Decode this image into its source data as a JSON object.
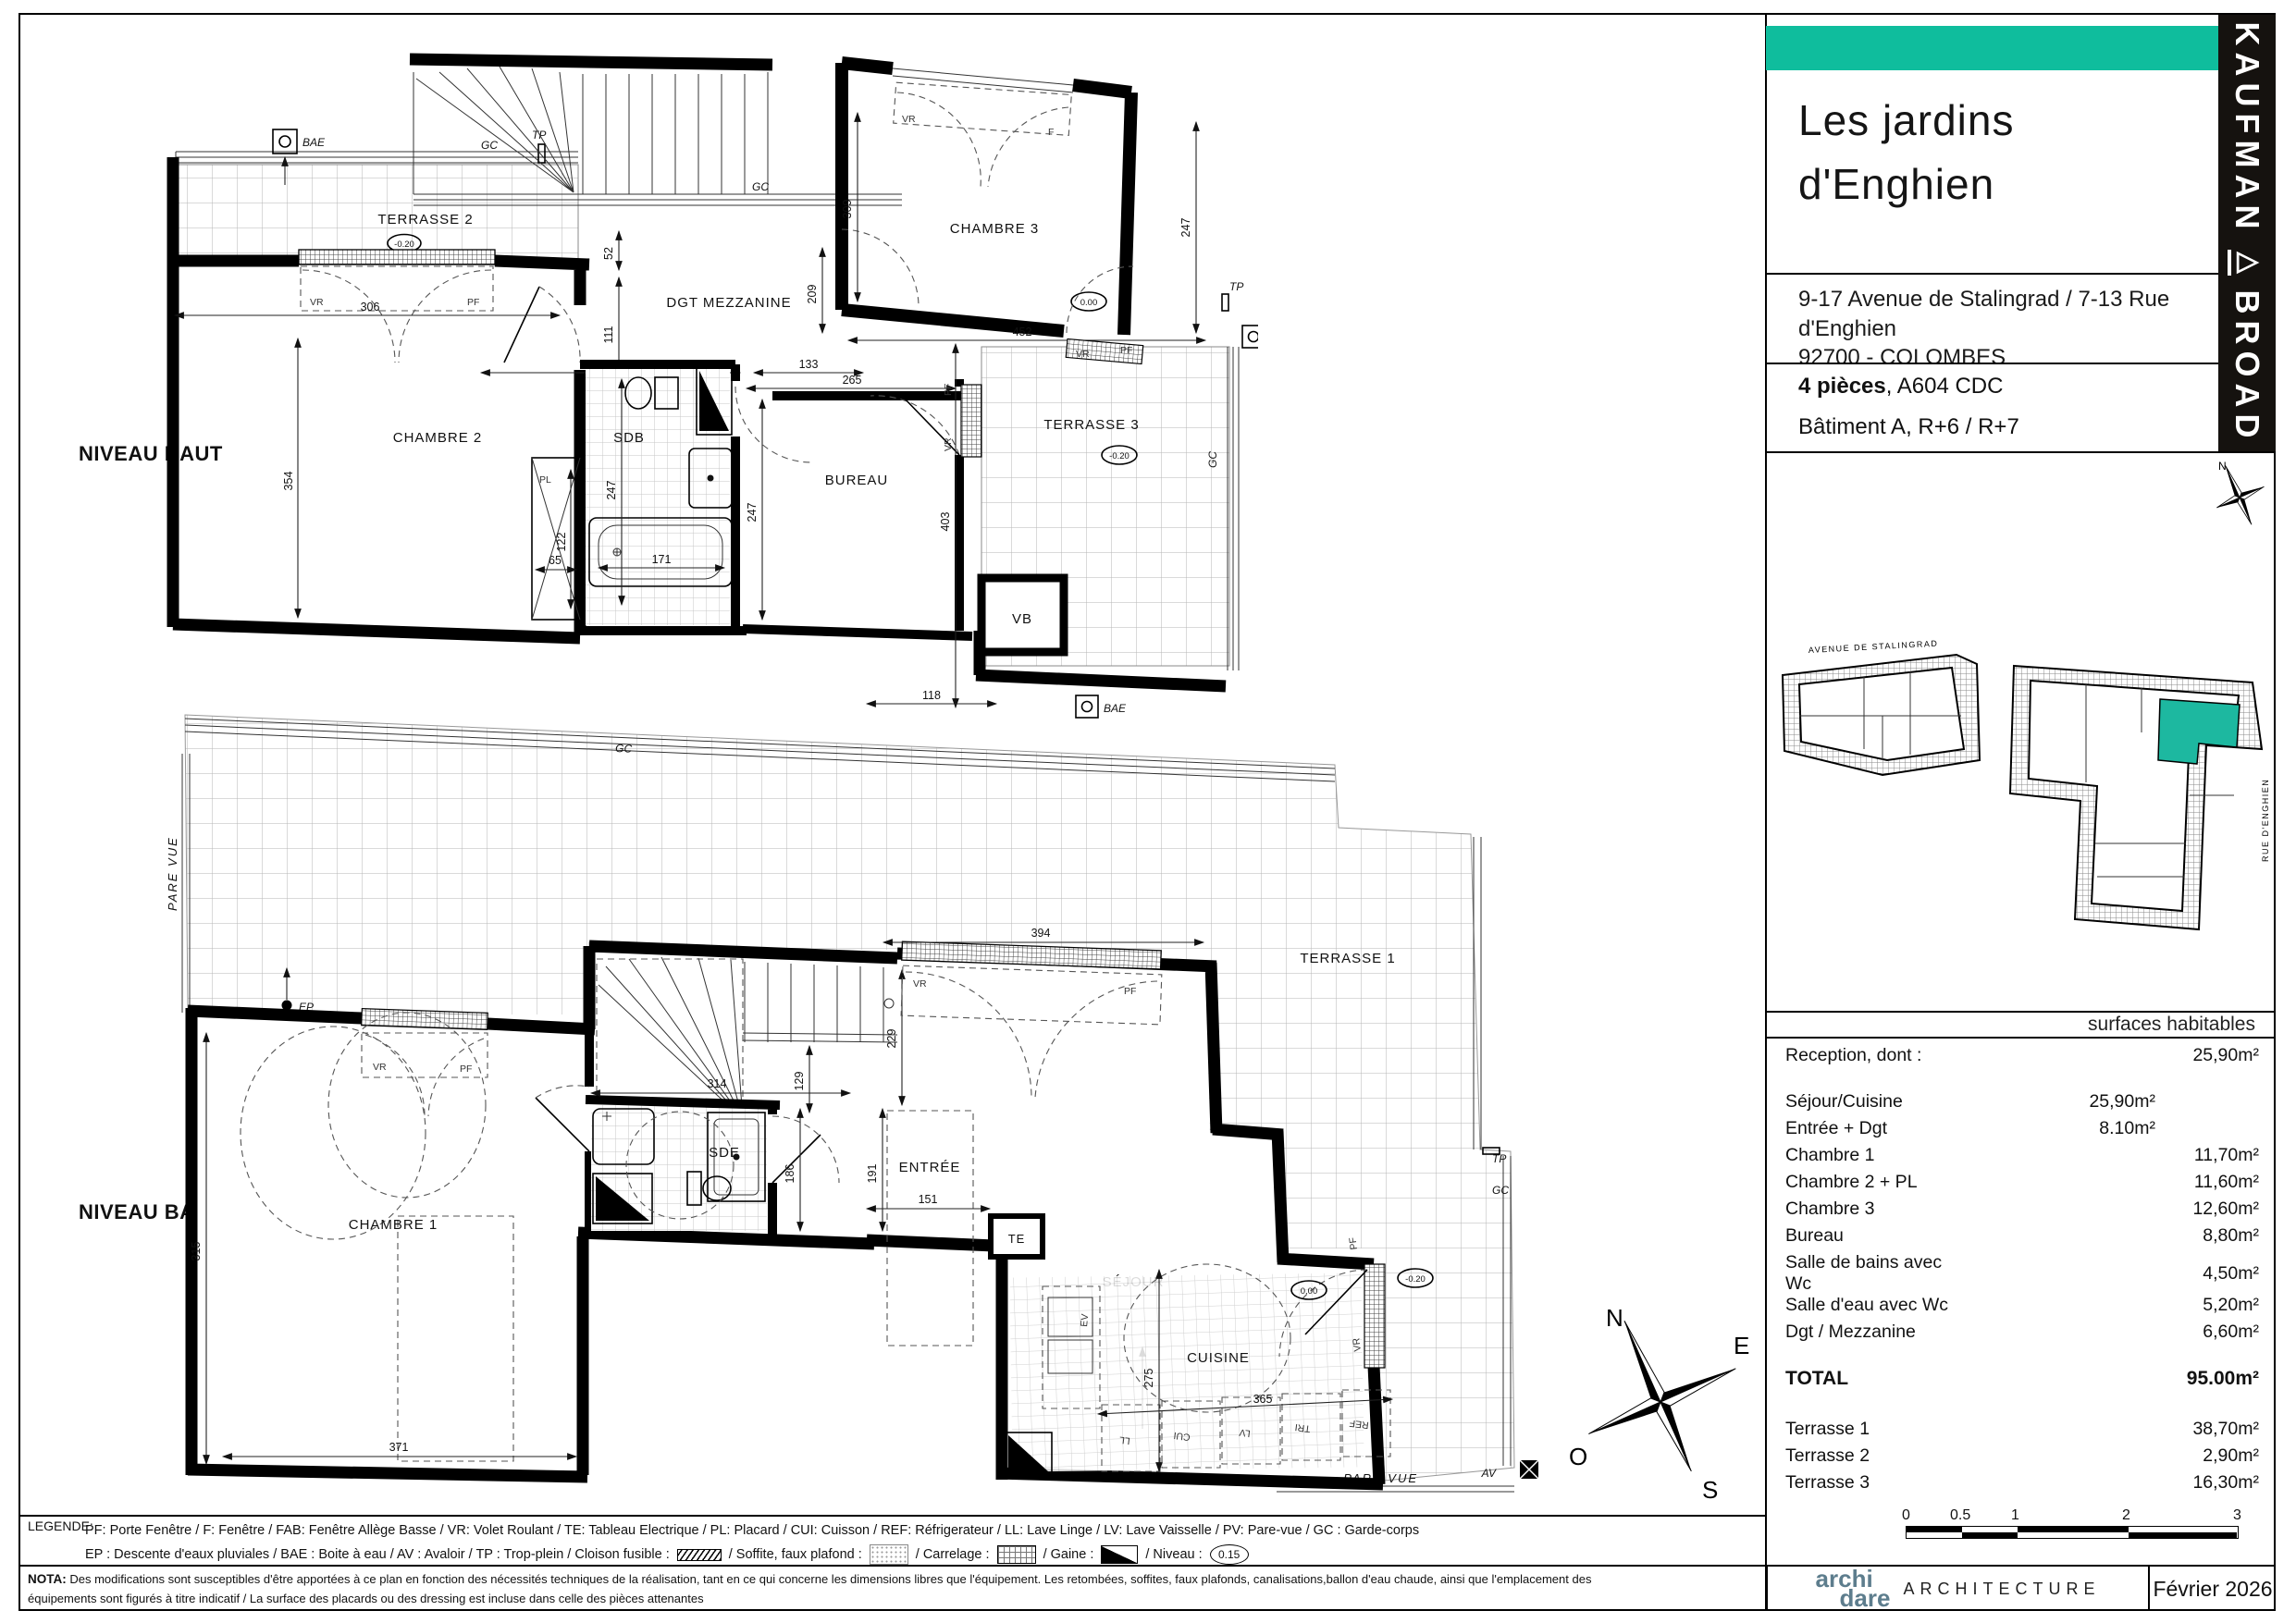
{
  "header": {
    "title_line1": "Les jardins",
    "title_line2": "d'Enghien",
    "address_line1": "9-17 Avenue de Stalingrad / 7-13 Rue",
    "address_line2": "d'Enghien",
    "address_line3": "92700 -  COLOMBES",
    "unit_rooms": "4 pièces",
    "unit_ref": ", A604 CDC",
    "building": "Bâtiment A, R+6 / R+7",
    "brand_word1": "KAUFMAN",
    "brand_logo": "△",
    "brand_word2": "BROAD",
    "accent_color": "#0fbd9d"
  },
  "site_plan": {
    "street_top": "AVENUE DE STALINGRAD",
    "street_right": "RUE D'ENGHIEN",
    "unit_color": "#1db8a0"
  },
  "surfaces": {
    "header": "surfaces habitables",
    "rows": [
      {
        "label": "Reception, dont :",
        "mid": "",
        "val": "25,90m²",
        "cls": ""
      },
      {
        "label": "",
        "mid": "",
        "val": "",
        "cls": "sp"
      },
      {
        "label": "Séjour/Cuisine",
        "mid": "25,90m²",
        "val": "",
        "cls": ""
      },
      {
        "label": "Entrée + Dgt",
        "mid": "8.10m²",
        "val": "",
        "cls": ""
      },
      {
        "label": "Chambre 1",
        "mid": "",
        "val": "11,70m²",
        "cls": ""
      },
      {
        "label": "Chambre 2 + PL",
        "mid": "",
        "val": "11,60m²",
        "cls": ""
      },
      {
        "label": "Chambre 3",
        "mid": "",
        "val": "12,60m²",
        "cls": ""
      },
      {
        "label": "Bureau",
        "mid": "",
        "val": "8,80m²",
        "cls": ""
      },
      {
        "label": "Salle de bains avec Wc",
        "mid": "",
        "val": "4,50m²",
        "cls": "wrap"
      },
      {
        "label": "Salle d'eau avec Wc",
        "mid": "",
        "val": "5,20m²",
        "cls": ""
      },
      {
        "label": "Dgt / Mezzanine",
        "mid": "",
        "val": "6,60m²",
        "cls": ""
      },
      {
        "label": "",
        "mid": "",
        "val": "",
        "cls": "sp"
      },
      {
        "label": "TOTAL",
        "mid": "",
        "val": "95.00m²",
        "cls": "total"
      },
      {
        "label": "",
        "mid": "",
        "val": "",
        "cls": "sp"
      },
      {
        "label": "Terrasse 1",
        "mid": "",
        "val": "38,70m²",
        "cls": ""
      },
      {
        "label": "Terrasse 2",
        "mid": "",
        "val": "2,90m²",
        "cls": ""
      },
      {
        "label": "Terrasse 3",
        "mid": "",
        "val": "16,30m²",
        "cls": ""
      }
    ]
  },
  "plans": {
    "upper_label": "NIVEAU HAUT",
    "lower_label": "NIVEAU BAS",
    "upper_rooms": {
      "terrasse2": "TERRASSE 2",
      "chambre2": "CHAMBRE 2",
      "dgt_mezzanine": "DGT MEZZANINE",
      "chambre3": "CHAMBRE 3",
      "sdb": "SDB",
      "bureau": "BUREAU",
      "terrasse3": "TERRASSE 3"
    },
    "lower_rooms": {
      "chambre1": "CHAMBRE 1",
      "dgt": "DGT",
      "sde": "SDE",
      "entree": "ENTRÉE",
      "sejour": "SÉJOUR",
      "cuisine": "CUISINE",
      "terrasse1": "TERRASSE 1"
    }
  },
  "tags": {
    "bae": "BAE",
    "tp": "TP",
    "gc": "GC",
    "vr": "VR",
    "pf": "PF",
    "f": "F",
    "pl": "PL",
    "vb": "VB",
    "ep": "EP",
    "av": "AV",
    "te": "TE",
    "pare_vue": "PARE VUE",
    "ev": "EV",
    "ll": "LL",
    "cui": "CUI",
    "lv": "LV",
    "tri": "TRI",
    "ref": "REF",
    "lvl_zero": "0.00",
    "lvl_minus": "-0.20"
  },
  "dims": {
    "d52": "52",
    "d65": "65",
    "d111": "111",
    "d118": "118",
    "d122": "122",
    "d129": "129",
    "d133": "133",
    "d151": "151",
    "d171": "171",
    "d186": "186",
    "d191": "191",
    "d209": "209",
    "d229": "229",
    "d241": "241",
    "d247": "247",
    "d265": "265",
    "d275": "275",
    "d306": "306",
    "d309": "309",
    "d314": "314",
    "d315": "315",
    "d354": "354",
    "d365": "365",
    "d371": "371",
    "d394": "394",
    "d403": "403",
    "d452": "452"
  },
  "compass": {
    "n": "N",
    "e": "E",
    "s": "S",
    "o": "O"
  },
  "legend": {
    "title": "LEGENDE:",
    "line1": "PF: Porte Fenêtre  /  F: Fenêtre  /  FAB: Fenêtre Allège Basse  /  VR: Volet Roulant  /  TE: Tableau Electrique  /  PL: Placard  /  CUI: Cuisson  /  REF: Réfrigerateur  /  LL: Lave Linge  /  LV: Lave Vaisselle  /  PV: Pare-vue  /  GC : Garde-corps",
    "l2a": "EP : Descente d'eaux pluviales  /  BAE : Boite à eau  /  AV : Avaloir  /  TP : Trop-plein  /  Cloison fusible :",
    "l2b": "/  Soffite, faux plafond :",
    "l2c": "/  Carrelage :",
    "l2d": "/  Gaine :",
    "l2e": "/  Niveau :",
    "niveau_value": "0.15"
  },
  "nota": {
    "label": "NOTA:",
    "line1": "Des modifications sont susceptibles d'être apportées à ce plan en fonction des nécessités techniques de la réalisation, tant en ce qui concerne les dimensions libres que l'équipement. Les retombées, soffites, faux plafonds, canalisations,ballon d'eau chaude, ainsi que l'emplacement des",
    "line2": "équipements sont figurés à titre indicatif / La surface des placards ou des dressing est incluse dans celle des pièces attenantes"
  },
  "footer": {
    "firm_a": "archi",
    "firm_b": "dare",
    "firm_c": "ARCHITECTURE",
    "date": "Février 2026"
  },
  "scale_bar": {
    "t0": "0",
    "t1": "0.5",
    "t2": "1",
    "t3": "2",
    "t4": "3"
  }
}
